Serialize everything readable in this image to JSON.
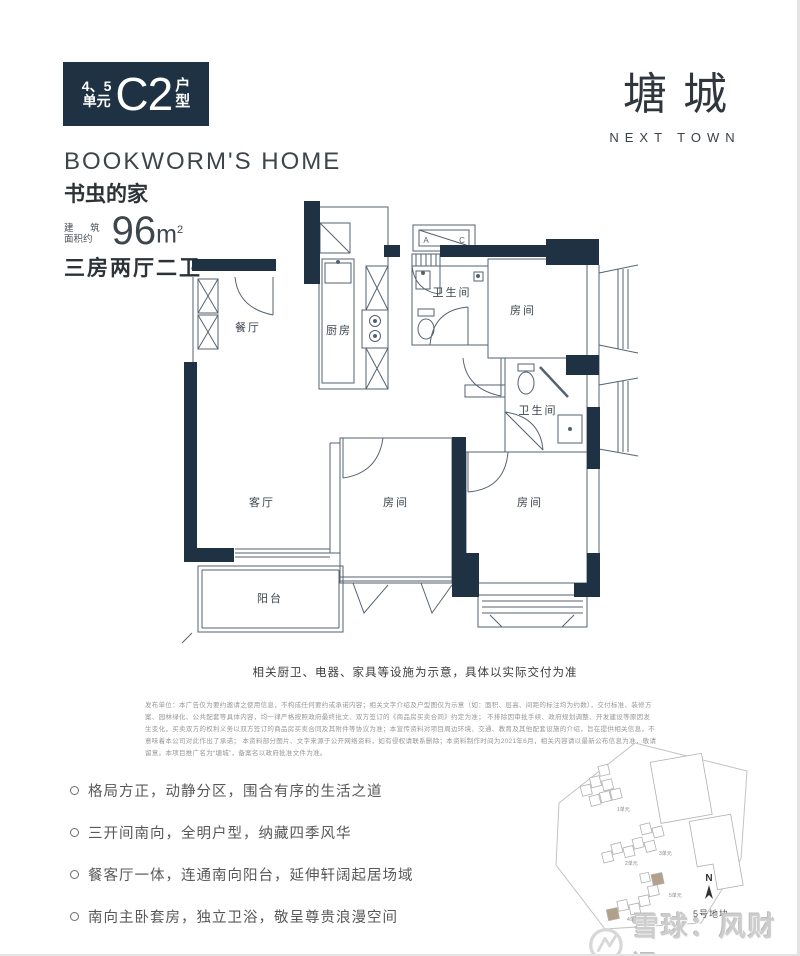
{
  "badge": {
    "unit_top": "4、5",
    "unit_bottom": "单元",
    "code": "C2",
    "type_top": "户",
    "type_bottom": "型"
  },
  "brand": {
    "name_cn": "塘城",
    "name_en": "NEXT TOWN"
  },
  "headline": {
    "en": "BOOKWORM'S HOME",
    "cn": "书虫的家"
  },
  "area": {
    "label_line1": "建 筑",
    "label_line2": "面积约",
    "value": "96",
    "unit": "m",
    "sup": "2"
  },
  "rooms_type": "三房两厅二卫",
  "floorplan": {
    "rooms": [
      {
        "name": "餐厅"
      },
      {
        "name": "厨房"
      },
      {
        "name": "卫生间"
      },
      {
        "name": "房间"
      },
      {
        "name": "卫生间"
      },
      {
        "name": "客厅"
      },
      {
        "name": "房间"
      },
      {
        "name": "房间"
      },
      {
        "name": "阳台"
      }
    ],
    "ac": {
      "a": "A",
      "c": "C"
    }
  },
  "caption": "相关厨卫、电器、家具等设施为示意，具体以实际交付为准",
  "disclaimer": {
    "l1": "发布单位：本广告仅为要约邀请之使用信息，不构成任何要约或承诺内容；相关文字介绍及户型图仅为示意（如：面积、层高、间距的标注均为约数），交付标准、装修方案、园林绿化、公共配套等具体内容，均一律严格按照政府最终批文、双方签订的《商品房买卖合同》约定为准；",
    "l2": "不排除因审批手续、政府规划调整、开发建设等原因发生变化，买卖双方的权利义务以双方签订的商品房买卖合同及其附件等协议为准；本宣传资料对项目周边环境、交通、教育及其他配套设施的介绍，旨在提供相关信息，不意味着本公司对此作出了承诺；",
    "l3": "本资料部分图片、文字来源于公开网络资料，如有侵权请联系删除；本资料制作时间为2021年6月，相关内容请以最新公布信息为准，敬请留意。本项目推广名为“塘城”，备案名以政府批准文件为准。"
  },
  "features": [
    {
      "text": "格局方正，动静分区，围合有序的生活之道"
    },
    {
      "text": "三开间南向，全明户型，纳藏四季风华"
    },
    {
      "text": "餐客厅一体，连通南向阳台，延伸轩阔起居场域"
    },
    {
      "text": "南向主卧套房，独立卫浴，敬呈尊贵浪漫空间"
    }
  ],
  "siteplan": {
    "plot_label": "5号地块",
    "north_label": "N",
    "unit_labels": [
      "1单元",
      "2单元",
      "3单元",
      "4单元",
      "5单元"
    ],
    "highlight_color": "#b3a08a"
  },
  "watermark": {
    "text": "雪球：风财讯"
  },
  "colors": {
    "navy": "#1e3243",
    "wall": "#566270",
    "accent_tan": "#b3a08a"
  }
}
